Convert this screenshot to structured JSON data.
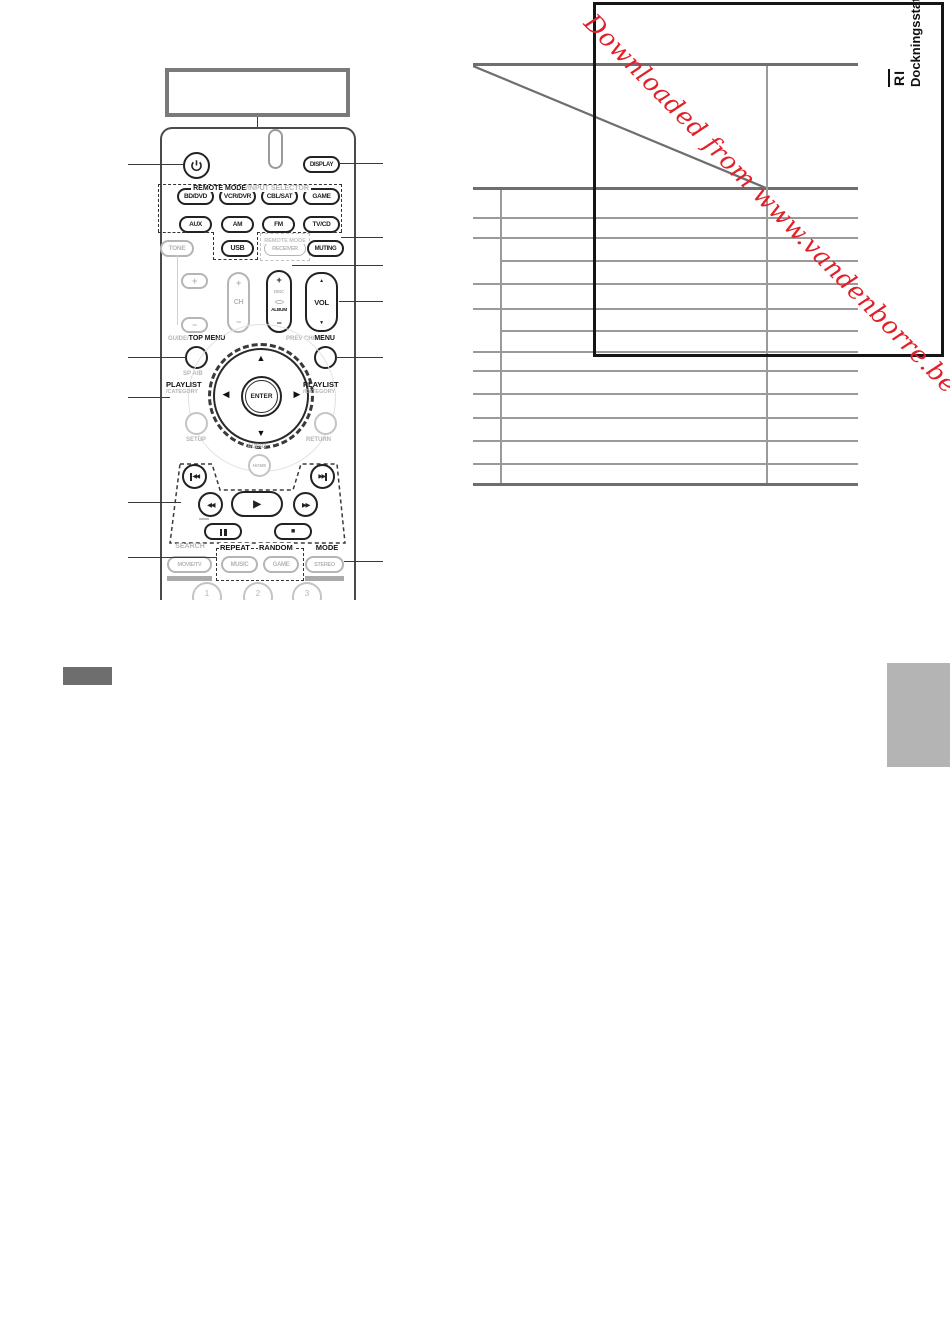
{
  "watermark": {
    "text": "Downloaded from www.vandenborre.be",
    "color": "#e2202a"
  },
  "table": {
    "col_header_line1": "RI",
    "col_header_line2": "Dockningsstation"
  },
  "remote": {
    "display": "DISPLAY",
    "section_title_bold": "REMOTE MODE",
    "section_title_gray": "/INPUT SELECTOR",
    "mode_buttons": [
      "BD/DVD",
      "VCR/DVR",
      "CBL/SAT",
      "GAME",
      "AUX",
      "AM",
      "FM",
      "TV/CD"
    ],
    "tone": "TONE",
    "usb": "USB",
    "receiver": "RECEIVER",
    "muting": "MUTING",
    "receiver_box_label": "REMOTE MODE",
    "plus": "+",
    "minus": "−",
    "ch": {
      "plus": "+",
      "label": "CH",
      "minus": "−"
    },
    "disc": {
      "plus": "+",
      "top": "DISC",
      "bottom": "ALBUM",
      "minus": "−"
    },
    "vol": {
      "label": "VOL",
      "up": "▲",
      "down": "▼"
    },
    "guide_gray": "GUIDE/",
    "guide_bold": "TOP MENU",
    "sp_ab": "SP A/B",
    "prev_gray": "PREV CH/",
    "prev_bold": "MENU",
    "playlist": "PLAYLIST",
    "category": "/CATEGORY",
    "dpad": {
      "up": "▲",
      "down": "▼",
      "left": "◀",
      "right": "▶"
    },
    "enter": "ENTER",
    "setup": "SETUP",
    "return": "RETURN",
    "audio": "AUDIO",
    "home": "HOME",
    "search": "SEARCH",
    "repeat": "REPEAT",
    "random": "RANDOM",
    "mode": "MODE",
    "movie_tv": "MOVIE/TV",
    "music": "MUSIC",
    "game": "GAME",
    "stereo": "STEREO",
    "numbers": [
      "1",
      "2",
      "3"
    ]
  }
}
